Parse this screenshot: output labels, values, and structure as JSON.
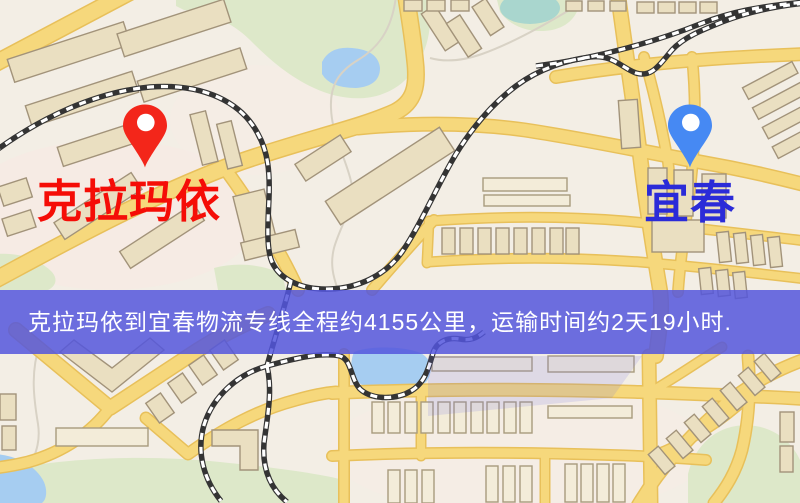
{
  "route": {
    "origin": "克拉玛依",
    "destination": "宜春",
    "distance_text": "4155公里",
    "duration_text": "2天19小时"
  },
  "banner": {
    "text": "克拉玛依到宜春物流专线全程约4155公里，运输时间约2天19小时."
  },
  "palette": {
    "map_bg": "#f3eee5",
    "road_fill": "#f6d87c",
    "park_green": "#dde8c9",
    "water_blue": "#a6cdf1",
    "banner_bg": "rgba(84,86,221,0.85)",
    "banner_text": "#ffffff",
    "origin_label": "#f50d07",
    "destination_label": "#2b2bd8",
    "origin_pin": "#f3261a",
    "destination_pin": "#4689f3"
  }
}
